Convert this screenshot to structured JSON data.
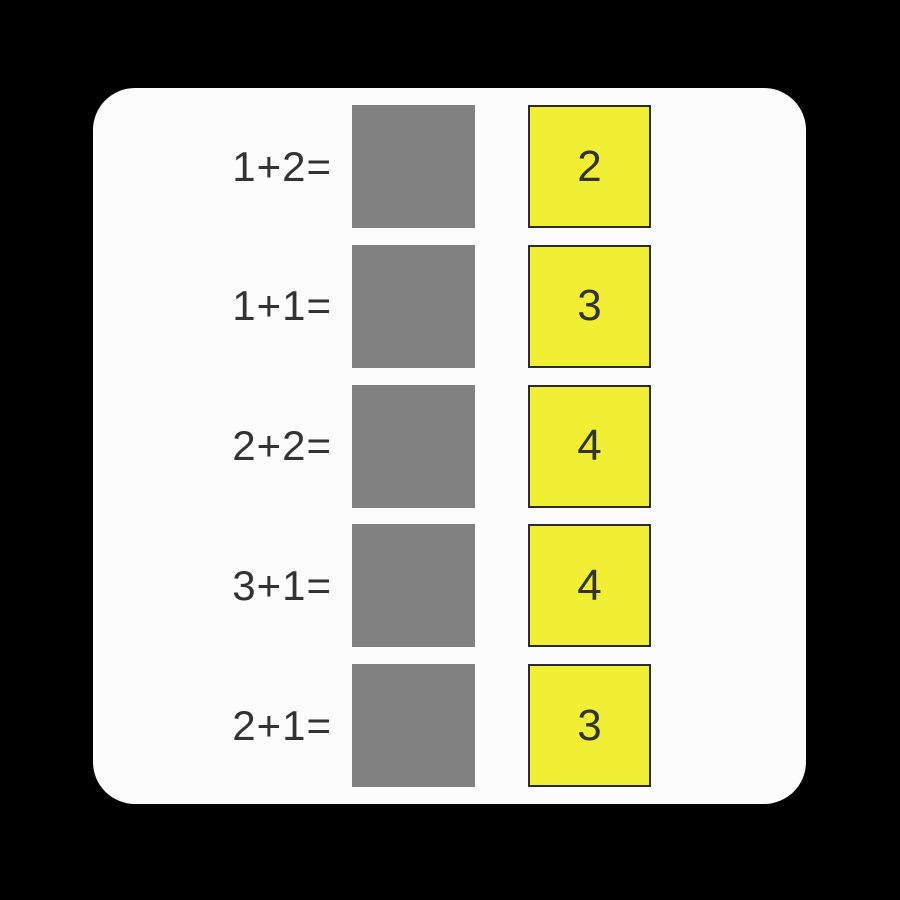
{
  "colors": {
    "background": "#000000",
    "card": "#fcfcfc",
    "slot_gray": "#818181",
    "tile_yellow": "#f1ef33",
    "tile_border": "#2b2b2b",
    "text": "#333333"
  },
  "rows": [
    {
      "expression": "1+2=",
      "answer": "2"
    },
    {
      "expression": "1+1=",
      "answer": "3"
    },
    {
      "expression": "2+2=",
      "answer": "4"
    },
    {
      "expression": "3+1=",
      "answer": "4"
    },
    {
      "expression": "2+1=",
      "answer": "3"
    }
  ]
}
